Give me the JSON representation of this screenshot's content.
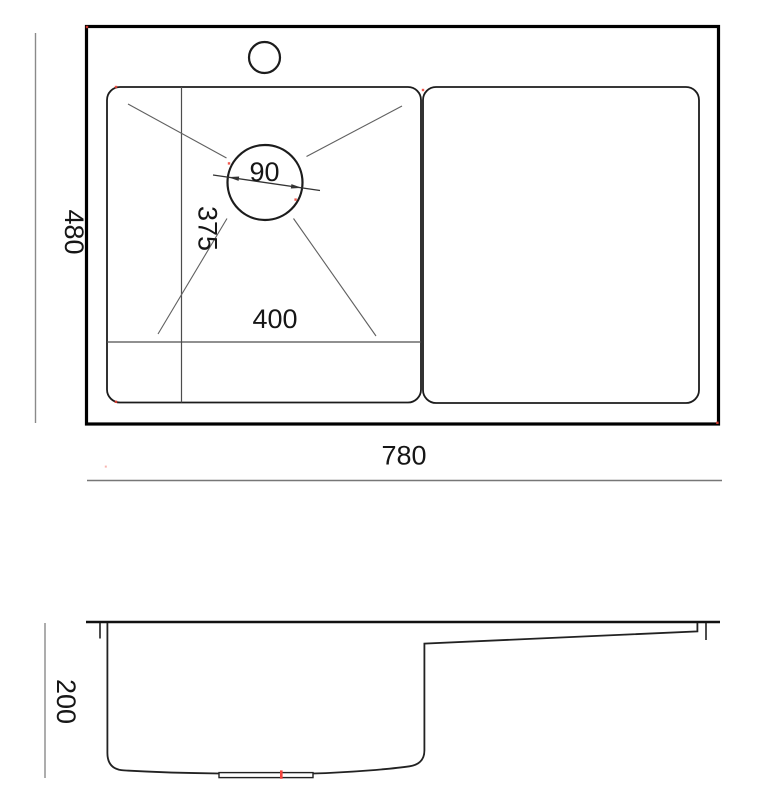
{
  "top_view": {
    "overall_width_label": "780",
    "overall_depth_label": "480",
    "bowl_width_label": "400",
    "bowl_depth_label": "375",
    "drain_diameter_label": "90"
  },
  "side_view": {
    "height_label": "200"
  },
  "colors": {
    "outer_outline": "#000000",
    "part_outline": "#1c1c1c",
    "thin_line": "#4d4d4d",
    "crease_line": "#606060",
    "dim_line": "#8a8a8a",
    "text": "#161616",
    "snap_marker": "#ee3d30",
    "drain_mark_red": "#f4433c",
    "background": "#ffffff"
  }
}
